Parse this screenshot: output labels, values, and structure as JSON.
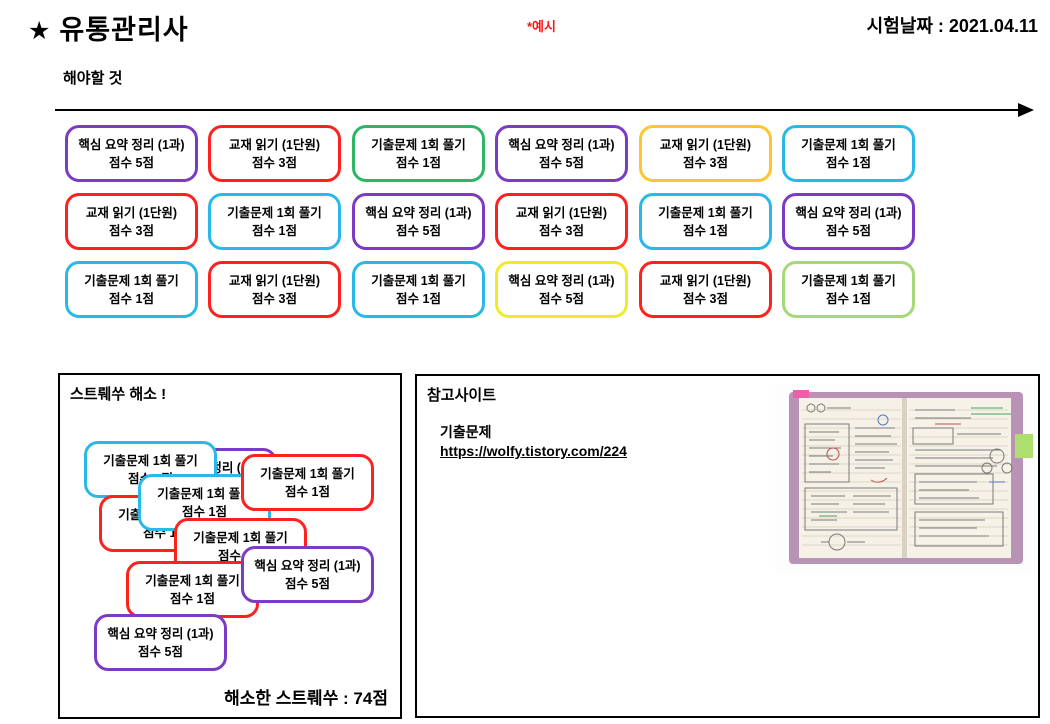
{
  "header": {
    "star_icon": "★",
    "title": "유통관리사",
    "example_note": "*예시",
    "exam_date": "시험날짜 : 2021.04.11",
    "note_color": "#ff1414"
  },
  "todo": {
    "section_label": "해야할 것",
    "cards": [
      {
        "line1": "핵심 요약 정리 (1과)",
        "line2": "점수 5점",
        "color": "purple"
      },
      {
        "line1": "교재 읽기 (1단원)",
        "line2": "점수 3점",
        "color": "red"
      },
      {
        "line1": "기출문제 1회 풀기",
        "line2": "점수 1점",
        "color": "green"
      },
      {
        "line1": "핵심 요약 정리 (1과)",
        "line2": "점수 5점",
        "color": "purple"
      },
      {
        "line1": "교재 읽기 (1단원)",
        "line2": "점수 3점",
        "color": "gold"
      },
      {
        "line1": "기출문제 1회 풀기",
        "line2": "점수 1점",
        "color": "cyan"
      },
      {
        "line1": "교재 읽기 (1단원)",
        "line2": "점수 3점",
        "color": "red"
      },
      {
        "line1": "기출문제 1회 풀기",
        "line2": "점수 1점",
        "color": "cyan"
      },
      {
        "line1": "핵심 요약 정리 (1과)",
        "line2": "점수 5점",
        "color": "purple"
      },
      {
        "line1": "교재 읽기 (1단원)",
        "line2": "점수 3점",
        "color": "red"
      },
      {
        "line1": "기출문제 1회 풀기",
        "line2": "점수 1점",
        "color": "cyan"
      },
      {
        "line1": "핵심 요약 정리 (1과)",
        "line2": "점수 5점",
        "color": "purple"
      },
      {
        "line1": "기출문제 1회 풀기",
        "line2": "점수 1점",
        "color": "cyan"
      },
      {
        "line1": "교재 읽기 (1단원)",
        "line2": "점수 3점",
        "color": "red"
      },
      {
        "line1": "기출문제 1회 풀기",
        "line2": "점수 1점",
        "color": "cyan"
      },
      {
        "line1": "핵심 요약 정리 (1과)",
        "line2": "점수 5점",
        "color": "yellow"
      },
      {
        "line1": "교재 읽기 (1단원)",
        "line2": "점수 3점",
        "color": "red"
      },
      {
        "line1": "기출문제 1회 풀기",
        "line2": "점수 1점",
        "color": "lightgreen"
      }
    ]
  },
  "stress": {
    "title": "스트뤠쑤 해소 !",
    "total_label": "해소한 스트뤠쑤 : 74점",
    "cards": [
      {
        "line1": "핵심 요약 정리 (1과)",
        "line2": "점수 5점",
        "color": "purple"
      },
      {
        "line1": "기출문제 1회 풀기",
        "line2": "점수 1점",
        "color": "cyan"
      },
      {
        "line1": "기출문제 1회 풀기",
        "line2": "점수 1점",
        "color": "red"
      },
      {
        "line1": "기출문제 1회 풀기",
        "line2": "점수 1점",
        "color": "cyan"
      },
      {
        "line1": "기출문제 1회 풀기",
        "line2": "점수 1점",
        "color": "red"
      },
      {
        "line1": "기출문제 1회 풀기",
        "line2": "점수 1점",
        "color": "red"
      },
      {
        "line1": "기출문제 1회 풀기",
        "line2": "점수 1점",
        "color": "red"
      },
      {
        "line1": "핵심 요약 정리 (1과)",
        "line2": "점수 5점",
        "color": "purple"
      },
      {
        "line1": "핵심 요약 정리 (1과)",
        "line2": "점수 5점",
        "color": "purple"
      }
    ]
  },
  "reference": {
    "title": "참고사이트",
    "link_label": "기출문제",
    "link_url": "https://wolfy.tistory.com/224",
    "image_name": "notebook-photo"
  },
  "palette": {
    "purple": "#7b3bc4",
    "red": "#ff2020",
    "green": "#2eb566",
    "gold": "#ffc52e",
    "cyan": "#29b8e8",
    "yellow": "#f2e92e",
    "lightgreen": "#a6d878"
  }
}
